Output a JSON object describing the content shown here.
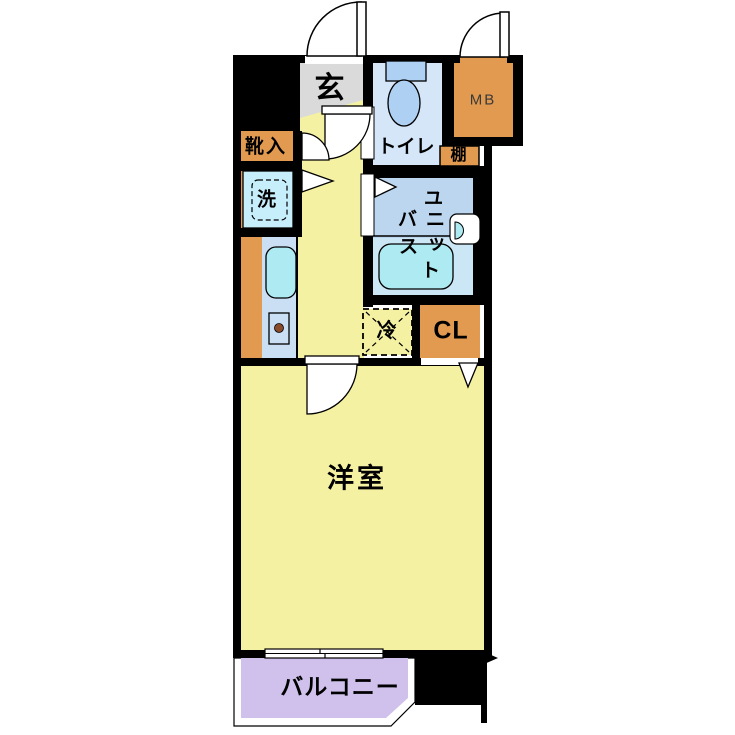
{
  "title": "apartment-floor-plan",
  "colors": {
    "wall": "#000000",
    "floor_yellow": "#f5f1a3",
    "genkan_gray": "#dadada",
    "toilet_room_blue": "#d4e6f7",
    "toilet_fixture_blue": "#aed0f2",
    "bath_room_blue": "#bcd6ef",
    "tub_zone_blue": "#cbe6f4",
    "tub_cyan": "#aeeaf2",
    "counter_blue": "#cadef4",
    "washer_blue": "#c6eefb",
    "cabinet_orange": "#e29a50",
    "balcony_purple": "#cfc1eb",
    "burner_brown": "#8b4a2a"
  },
  "labels": {
    "genkan": "玄",
    "toilet": "トイレ",
    "meter_box": "MB",
    "shoe_cabinet": "靴入",
    "shelf": "棚",
    "washer": "洗",
    "unit_bath": [
      "ユ",
      "ニ",
      "ッ",
      "ト",
      "バ",
      "ス"
    ],
    "unit_bath_full": "ユニットバス",
    "fridge": "冷",
    "closet": "CL",
    "western_room": "洋室",
    "balcony": "バルコニー"
  }
}
